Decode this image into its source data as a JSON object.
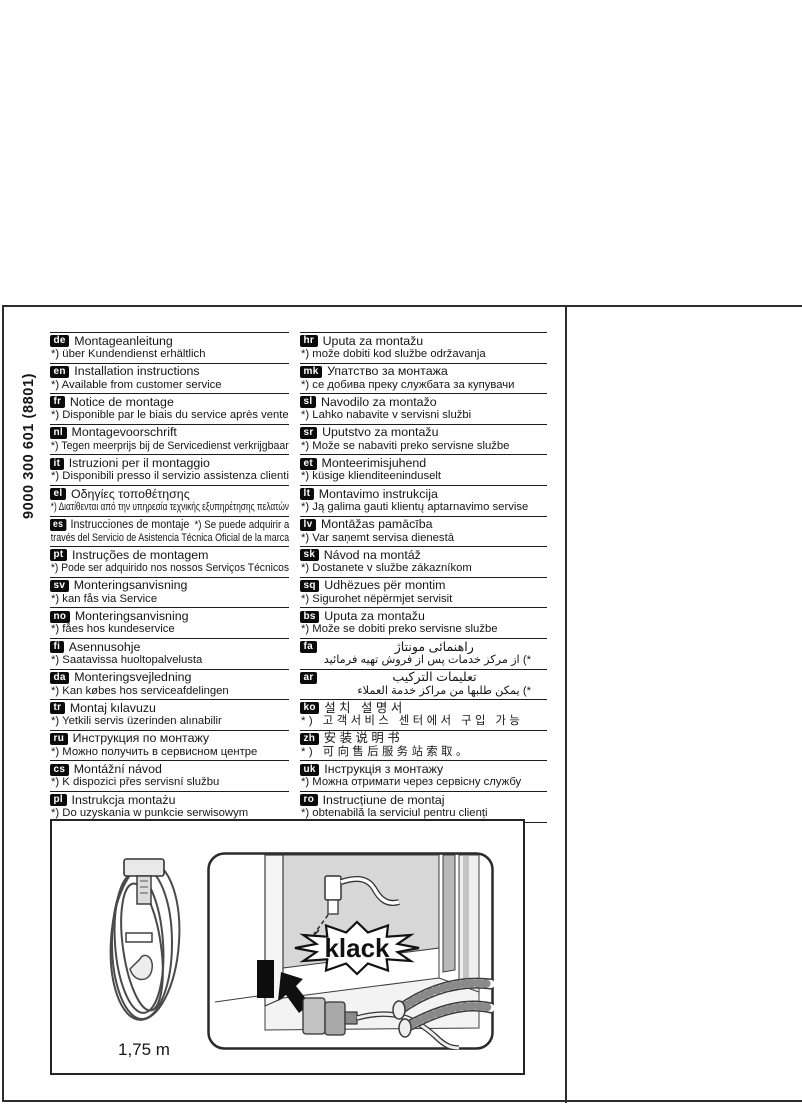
{
  "page": {
    "product_code": "9000 300 601  (8801)",
    "figure": {
      "cable_length_label": "1,75 m",
      "sound_label": "klack"
    },
    "colors": {
      "ink": "#1a1a1a",
      "badge_bg": "#0b0b0b",
      "panel_gray": "#d7d7d7",
      "line": "#2c2c2c"
    }
  },
  "languages": {
    "left": [
      {
        "code": "de",
        "title": "Montageanleitung",
        "note": "*) über Kundendienst erhältlich"
      },
      {
        "code": "en",
        "title": "Installation instructions",
        "note": "*) Available from customer service"
      },
      {
        "code": "fr",
        "title": "Notice de montage",
        "note": "*) Disponible par le biais du service après vente"
      },
      {
        "code": "nl",
        "title": "Montagevoorschrift",
        "note": "*) Tegen meerprijs bij de Servicedienst verkrijgbaar"
      },
      {
        "code": "it",
        "title": "Istruzioni per il montaggio",
        "note": "*) Disponibili presso il servizio assistenza clienti"
      },
      {
        "code": "el",
        "title": "Οδηγίες τοποθέτησης",
        "note": "*) Διατίθενται από την υπηρεσία τεχνικής εξυπηρέτησης πελατών"
      },
      {
        "code": "es",
        "title": "Instrucciones de montaje",
        "layout": "flow",
        "note": "*) Se puede adquirir a",
        "note2": "través del Servicio de Asistencia Técnica Oficial de la marca"
      },
      {
        "code": "pt",
        "title": "Instruções de montagem",
        "note": "*) Pode ser adquirido nos nossos Serviços Técnicos"
      },
      {
        "code": "sv",
        "title": "Monteringsanvisning",
        "note": "*) kan fås via Service"
      },
      {
        "code": "no",
        "title": "Monteringsanvisning",
        "note": "*) fåes hos kundeservice"
      },
      {
        "code": "fi",
        "title": "Asennusohje",
        "note": "*) Saatavissa huoltopalvelusta"
      },
      {
        "code": "da",
        "title": "Monteringsvejledning",
        "note": "*) Kan købes hos serviceafdelingen"
      },
      {
        "code": "tr",
        "title": "Montaj kılavuzu",
        "note": "*) Yetkili servis üzerinden alınabilir"
      },
      {
        "code": "ru",
        "title": "Инструкция по монтажу",
        "note": "*) Можно получить в сервисном центре"
      },
      {
        "code": "cs",
        "title": "Montážní návod",
        "note": "*) K dispozici přes servisní službu"
      },
      {
        "code": "pl",
        "title": "Instrukcja montażu",
        "note": "*) Do uzyskania w punkcie serwisowym"
      },
      {
        "code": "hu",
        "title": "Szerelési utasítás",
        "note": "*) A vevőszolgálaton keresztül kapható:"
      }
    ],
    "right": [
      {
        "code": "hr",
        "title": "Uputa za montažu",
        "note": "*) može dobiti kod službe održavanja"
      },
      {
        "code": "mk",
        "title": "Упатство за монтажа",
        "note": "*) се добива преку службата за купувачи"
      },
      {
        "code": "sl",
        "title": "Navodilo za montažo",
        "note": "*) Lahko nabavite v servisni službi"
      },
      {
        "code": "sr",
        "title": "Uputstvo za montažu",
        "note": "*) Može se nabaviti preko servisne službe"
      },
      {
        "code": "et",
        "title": "Monteerimisjuhend",
        "note": "*) küsige klienditeeninduselt"
      },
      {
        "code": "lt",
        "title": "Montavimo instrukcija",
        "note": "*) Ją galima gauti klientų aptarnavimo servise"
      },
      {
        "code": "lv",
        "title": "Montāžas pamācība",
        "note": "*) Var saņemt servisa dienestā"
      },
      {
        "code": "sk",
        "title": "Návod na montáž",
        "note": "*) Dostanete v službe zákazníkom"
      },
      {
        "code": "sq",
        "title": "Udhëzues për montim",
        "note": "*) Sigurohet nëpërmjet servisit"
      },
      {
        "code": "bs",
        "title": "Uputa za montažu",
        "note": "*) Može se dobiti preko servisne službe"
      },
      {
        "code": "fa",
        "title": "راهنمائی مونتاژ",
        "note": "*) از مرکز خدمات پس از فروش تهیه فرمائید",
        "rtl": true
      },
      {
        "code": "ar",
        "title": "تعليمات التركيب",
        "note": "*) يمكن طلبها من مراكز خدمة العملاء",
        "rtl": true
      },
      {
        "code": "ko",
        "title": "설치 설명서",
        "note": "*) 고객서비스 센터에서 구입 가능",
        "spaced": true
      },
      {
        "code": "zh",
        "title": "安装说明书",
        "note": "*) 可向售后服务站索取。",
        "spaced": true
      },
      {
        "code": "uk",
        "title": "Інструкція з монтажу",
        "note": "*) Можна отримати через сервісну службу"
      },
      {
        "code": "ro",
        "title": "Instrucțiune de montaj",
        "note": "*) obtenabilă la serviciul pentru clienți"
      }
    ]
  }
}
